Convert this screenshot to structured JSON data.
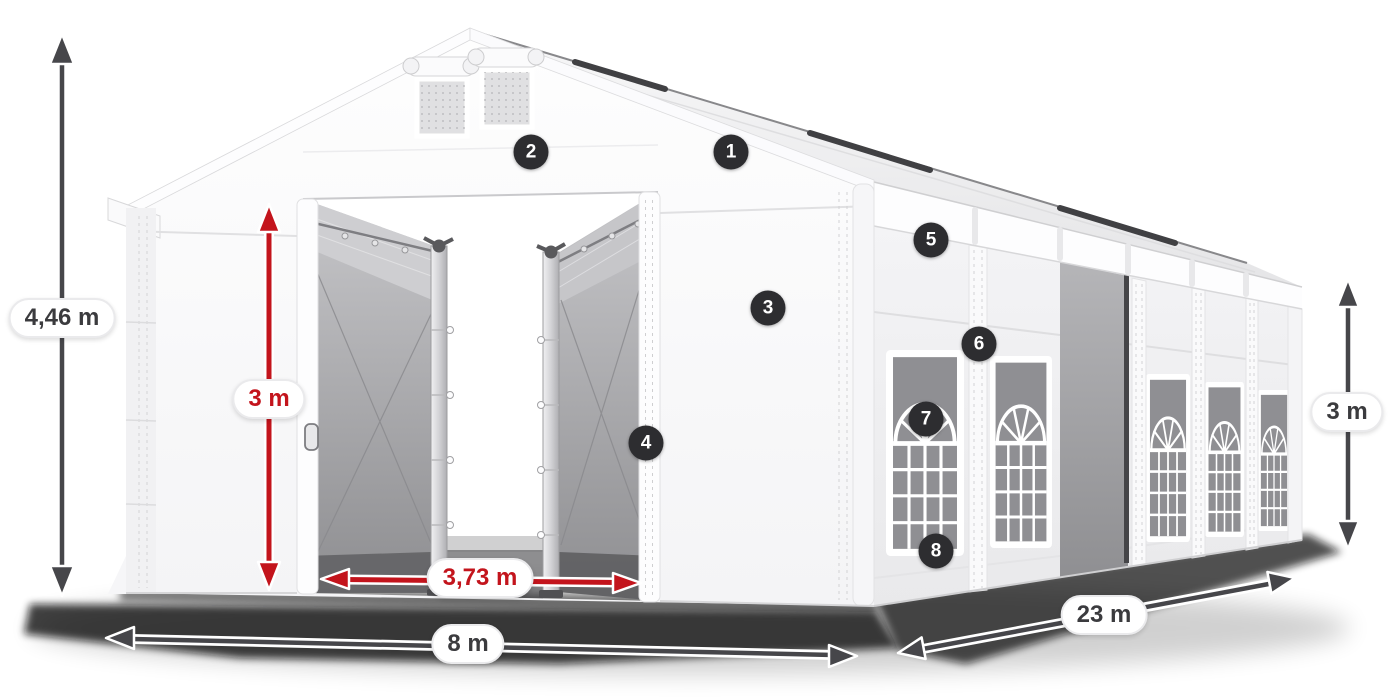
{
  "colors": {
    "canvas_bg": "#ffffff",
    "accent_red": "#c3141c",
    "arrow_dark": "#46464a",
    "badge_bg": "#2d2d30",
    "badge_text": "#ffffff",
    "label_text": "#3b3b3e",
    "label_bg": "#ffffff"
  },
  "dimensions": {
    "total_height_label": "4,46 m",
    "inner_height_label": "3 m",
    "door_width_label": "3,73 m",
    "front_width_label": "8 m",
    "side_length_label": "23 m",
    "side_height_label": "3 m"
  },
  "callouts": [
    {
      "number": "1"
    },
    {
      "number": "2"
    },
    {
      "number": "3"
    },
    {
      "number": "4"
    },
    {
      "number": "5"
    },
    {
      "number": "6"
    },
    {
      "number": "7"
    },
    {
      "number": "8"
    }
  ]
}
